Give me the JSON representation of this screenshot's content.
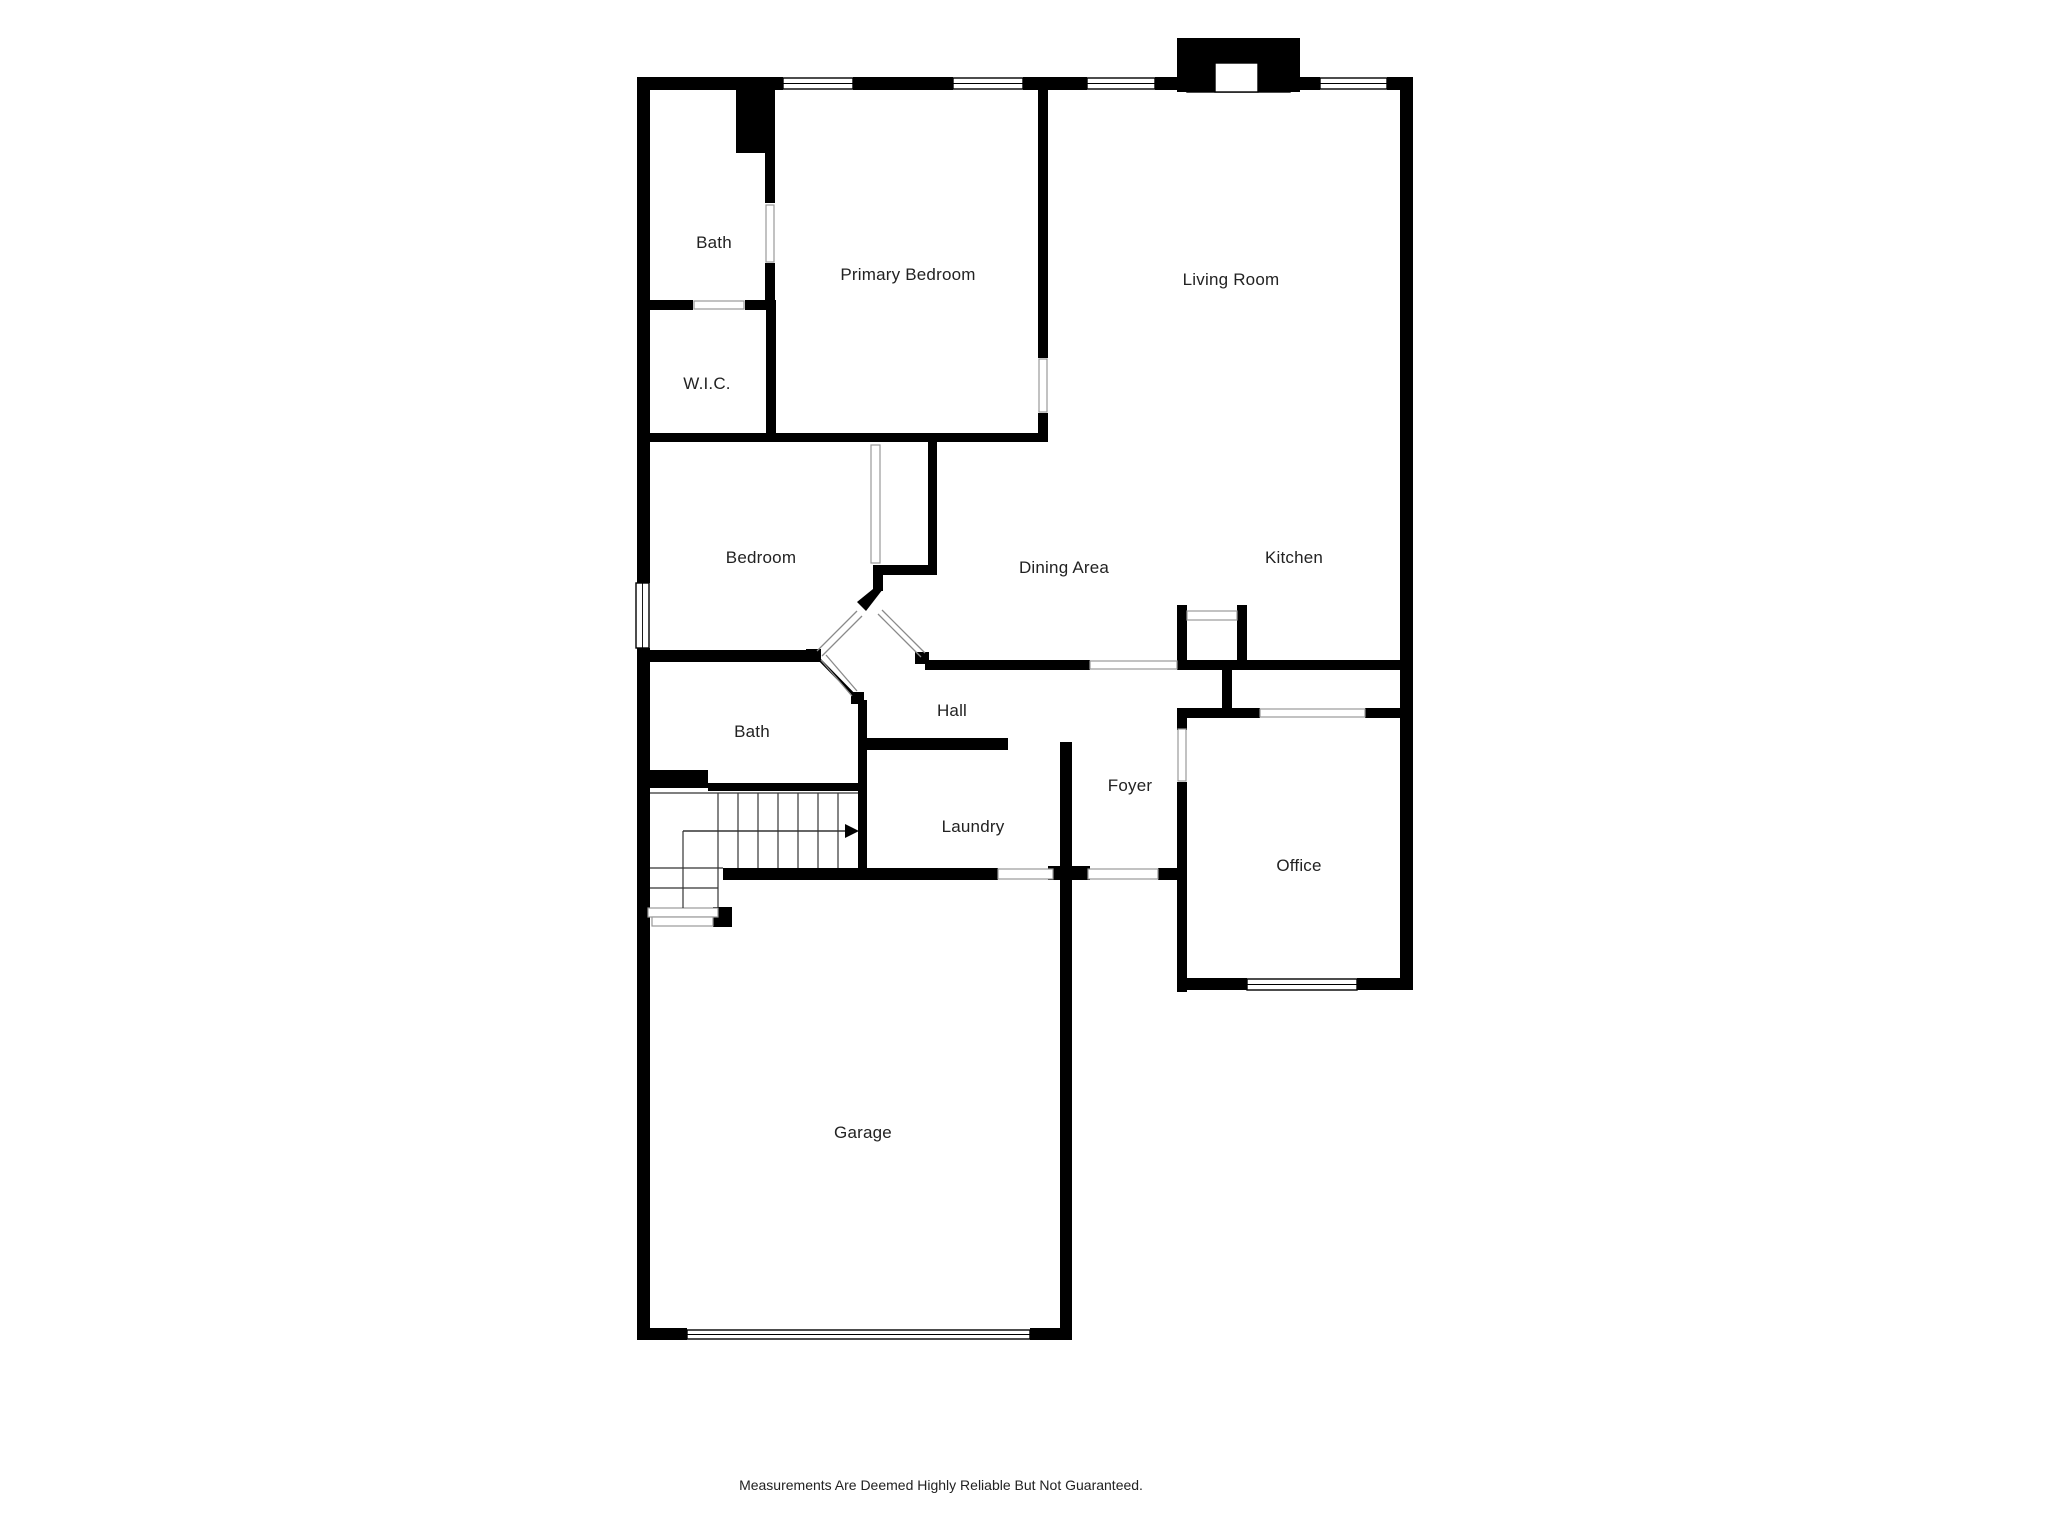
{
  "page": {
    "background": "#ffffff",
    "wall_color": "#000000",
    "thin_line_color": "#8a8a8a",
    "label_color": "#222222"
  },
  "floor_plan": {
    "disclaimer": "Measurements Are Deemed Highly Reliable But Not Guaranteed.",
    "rooms": [
      {
        "id": "bath-upper",
        "label": "Bath",
        "x": 714,
        "y": 243
      },
      {
        "id": "primary-bedroom",
        "label": "Primary Bedroom",
        "x": 908,
        "y": 275
      },
      {
        "id": "living-room",
        "label": "Living Room",
        "x": 1231,
        "y": 280
      },
      {
        "id": "wic",
        "label": "W.I.C.",
        "x": 707,
        "y": 384
      },
      {
        "id": "bedroom",
        "label": "Bedroom",
        "x": 761,
        "y": 558
      },
      {
        "id": "dining-area",
        "label": "Dining Area",
        "x": 1064,
        "y": 568
      },
      {
        "id": "kitchen",
        "label": "Kitchen",
        "x": 1294,
        "y": 558
      },
      {
        "id": "bath-lower",
        "label": "Bath",
        "x": 752,
        "y": 732
      },
      {
        "id": "hall",
        "label": "Hall",
        "x": 952,
        "y": 711
      },
      {
        "id": "foyer",
        "label": "Foyer",
        "x": 1130,
        "y": 786
      },
      {
        "id": "laundry",
        "label": "Laundry",
        "x": 973,
        "y": 827
      },
      {
        "id": "office",
        "label": "Office",
        "x": 1299,
        "y": 866
      },
      {
        "id": "garage",
        "label": "Garage",
        "x": 863,
        "y": 1133
      }
    ],
    "features": [
      "fireplace",
      "windows",
      "door-openings",
      "stairs",
      "stair-direction-arrow",
      "garage-door",
      "pantry-nook",
      "front-entry"
    ]
  }
}
